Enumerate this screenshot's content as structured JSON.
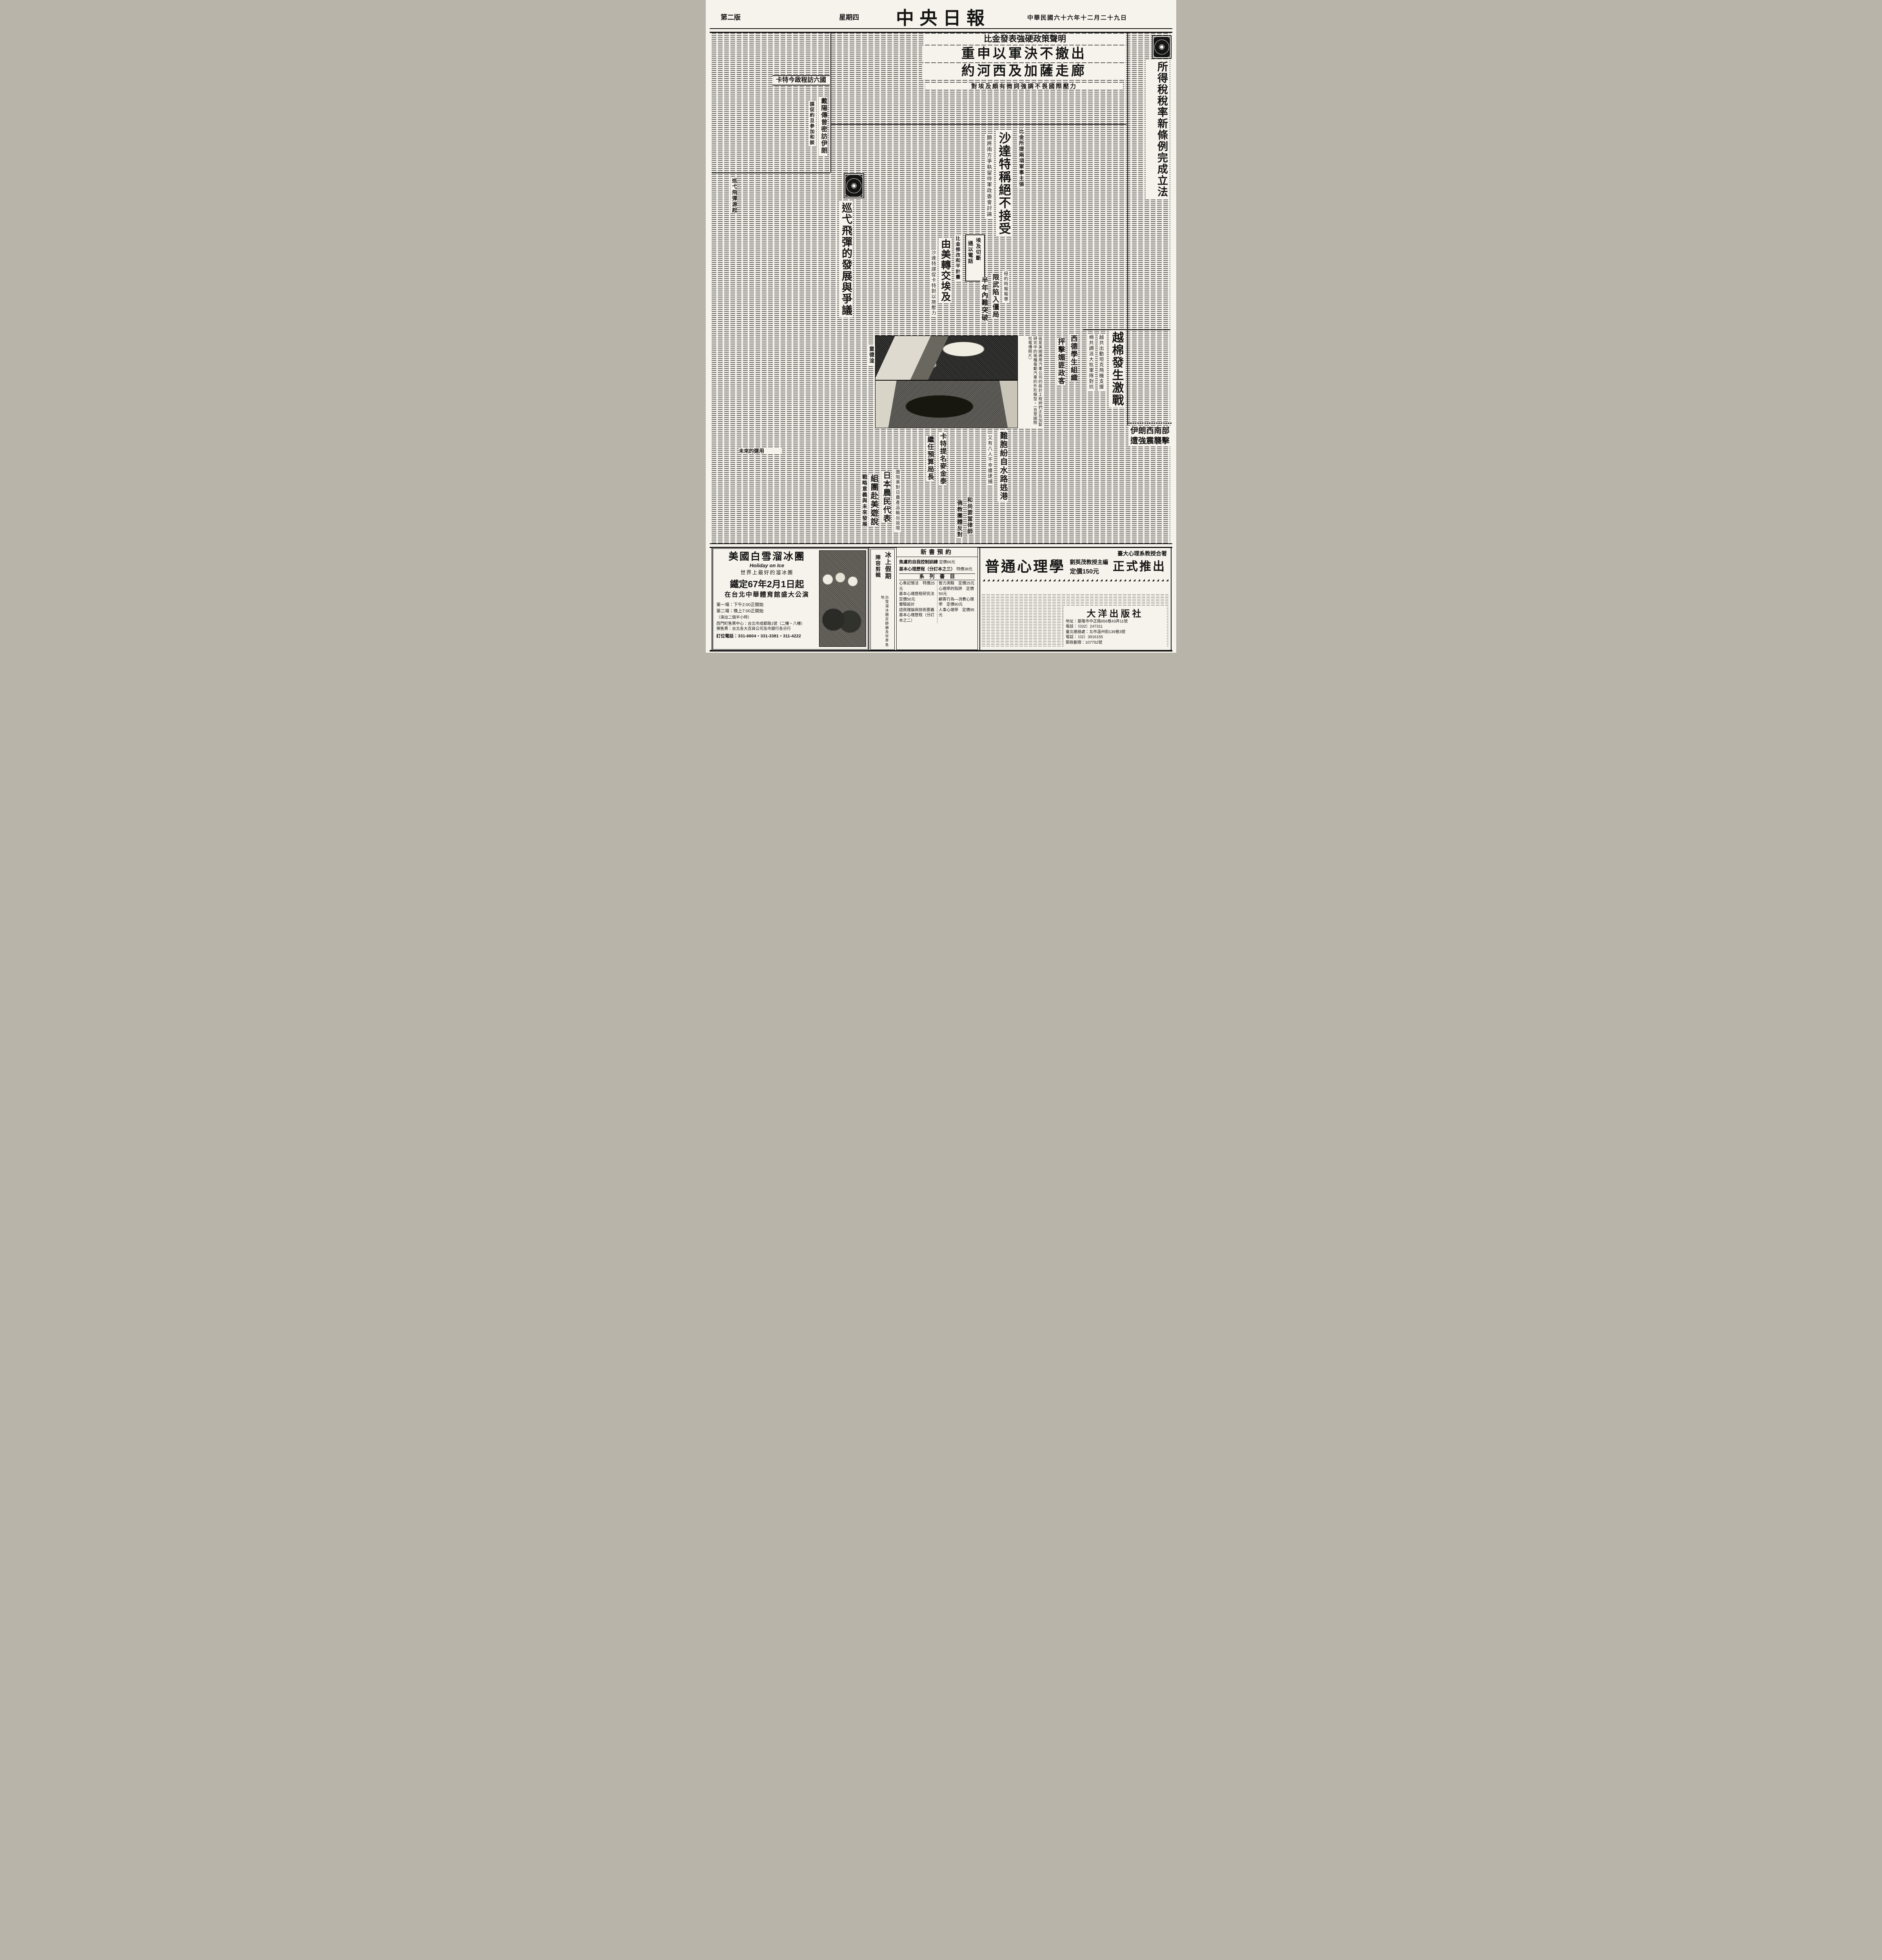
{
  "masthead": {
    "title": "中央日報",
    "page_label": "第二版",
    "weekday": "星期四",
    "date": "中華民國六十六年十二月二十九日"
  },
  "lead": {
    "kicker": "比金發表強硬政策聲明",
    "headline1": "重申以軍決不撤出",
    "headline2": "約河西及加薩走廊",
    "subhead": "對埃及頗有微詞強調不畏國際壓力"
  },
  "tax": {
    "headline": "所得稅稅率新條例完成立法"
  },
  "carter_trip": {
    "headline": "卡特今啟程訪六國"
  },
  "dayan": {
    "headline": "戴陽傳曾密訪伊朗",
    "subhead": "謀促約旦參加和談"
  },
  "sadat": {
    "kicker": "比金所提兩項軍事主張",
    "headline": "沙達特稱絕不接受",
    "subhead": "願將兩方爭執留待軍政委會討論"
  },
  "peace_plan": {
    "kicker": "比金修改和平計畫",
    "headline": "由美轉交埃及",
    "subhead": "沙達特謀促卡特對以施壓力"
  },
  "phone_cut": {
    "line1": "埃及切斷",
    "line2": "通以電話"
  },
  "salt": {
    "kicker": "紐約時報報導",
    "headline": "限武陷入僵局",
    "subhead": "半年內難突破"
  },
  "missile_feature": {
    "headline": "巡弋飛彈的發展與爭議",
    "byline": "童德淦",
    "section1": "巡弋飛彈源起",
    "section2": "戰略意義與未來發展",
    "section3": "未來的運用"
  },
  "ev_photo": {
    "caption": "這是美國通用汽車公司的設計工程師們正在加緊研究中的兩種電動汽車的外形模型。（合眾國際社電傳照片）"
  },
  "vietnam": {
    "headline": "越棉發生激戰",
    "subhead1": "越共出動坦克飛機支援",
    "subhead2": "棉共調派大批軍隊對抗"
  },
  "germany": {
    "line1": "西德學生組織",
    "line2": "抨擊媚匪政客"
  },
  "iran_quake": {
    "line1": "伊朗西南部",
    "line2": "遭強震襲擊"
  },
  "refugees": {
    "headline": "難胞紛自水路逃港",
    "subhead": "又有八人不幸遭逮捕"
  },
  "budget": {
    "line1": "卡特提名麥金泰",
    "line2": "繼任預算局長"
  },
  "japan_farmers": {
    "kicker": "圍阻美對日農產品輸出設限",
    "line1": "日本農民代表",
    "line2": "組團赴美遊說"
  },
  "monks": {
    "line1": "和尚要當律師",
    "line2": "佛教團體反對"
  },
  "ads": {
    "ice_show": {
      "title": "美國白雪溜冰團",
      "subtitle_en": "Holiday on Ice",
      "tagline": "世界上最好的溜冰團",
      "date_line": "鐵定67年2月1日起",
      "venue": "在台北中華體育館盛大公演",
      "show1": "第一場：下午2:00正開始",
      "show2": "第二場：晚上7:00正開始",
      "duration": "（演出二個半小時）",
      "box_office": "西門町售票中心：台北市成都路1號（二樓・八樓）",
      "presale": "預售票：台北各大百貨公司及市銀行各分行",
      "phone": "訂位電話：331-6604・331-3381・311-4222"
    },
    "lineup": {
      "title1": "冰上假期",
      "title2": "陣容剪輯",
      "note": "白雪溜冰團足跡遍及世界各地"
    },
    "books": {
      "header": "新書預約",
      "item1": "焦慮的自我控制訓練",
      "item1_price": "定價66元",
      "item2": "基本心理歷程（分訂本之三）",
      "item2_price": "特價38元",
      "series_header": "系　列　書　目",
      "list": [
        {
          "name": "心象記憶法",
          "price": "特價25元"
        },
        {
          "name": "基本心理歷程研究法",
          "price": "定價50元"
        },
        {
          "name": "實驗設計",
          "price": ""
        },
        {
          "name": "諮商理論與技術要義",
          "price": ""
        },
        {
          "name": "基本心理歷程（分訂本之二）",
          "price": ""
        },
        {
          "name": "智力測驗",
          "price": "定價25元"
        },
        {
          "name": "心理學的陷阱",
          "price": "定價50元"
        },
        {
          "name": "顧客行為—消費心理學",
          "price": "定價90元"
        },
        {
          "name": "人事心理學",
          "price": "定價95元"
        }
      ]
    },
    "psychology": {
      "kicker": "臺大心理系教授合著",
      "title": "普通心理學",
      "editor": "劉英茂教授主編",
      "price": "定價150元",
      "banner": "正式推出",
      "publisher": "大洋出版社",
      "address": "地址：基隆市中正路656巷43弄11號",
      "tel1": "電話：（032）247311",
      "liaison": "臺北連絡處：北市溫州街139巷3號",
      "tel2": "電話：（02）3916155",
      "postal": "郵政劃撥：107752號"
    }
  }
}
